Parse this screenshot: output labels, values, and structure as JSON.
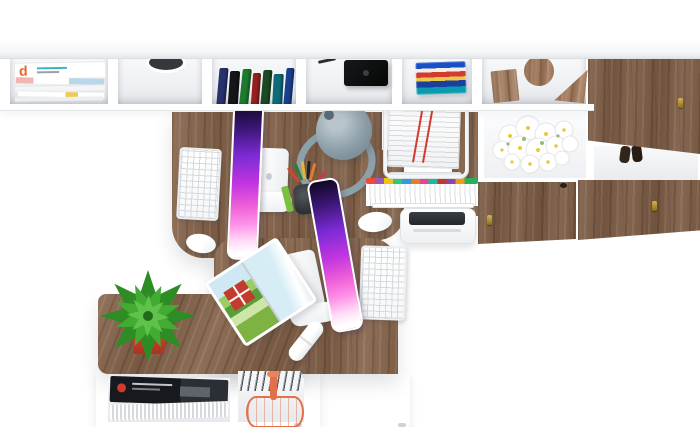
{
  "meta": {
    "title": "Top-down render of two-person home office furniture set",
    "view": "bird's-eye",
    "background_color": "#ffffff"
  },
  "palette": {
    "wood": "#85634a",
    "furniture_white": "#ffffff",
    "screen_purple": "#7c2bd6",
    "screen_pink": "#ff93e9",
    "lamp_gray": "#8c9ea8",
    "plant_green": "#43ab33",
    "pot_red": "#c7402c",
    "copper_basket": "#e0714a",
    "flower_white": "#ffffff",
    "flower_center_yellow": "#e8c83c",
    "speaker_black": "#0c0d0e"
  },
  "shelf": {
    "magazine_logo": "d",
    "book_spines": [
      "#28336e",
      "#14161a",
      "#1f7a2e",
      "#962020",
      "#1c4a23",
      "#0d6b7a",
      "#1b3f8f"
    ],
    "stacked_books": "linear-gradient(180deg,#1850c8 0 19%,#f5f0e6 19% 31%,#d23b2e 31% 47%,#ecc94b 47% 59%,#1a3f9e 59% 78%,#0a9bb0 78% 100%)",
    "contents": [
      "magazine stack",
      "cable grommet",
      "standing books",
      "black speaker box",
      "stacked blue books",
      "wooden bookends",
      "oak cabinet door"
    ]
  },
  "right_cabinet": {
    "contents": [
      "white daisy bouquet",
      "dark slippers",
      "oak doors with brass keyholes"
    ]
  },
  "workstations": {
    "desk_items": [
      "white monitor with purple screen",
      "white monitor with purple screen",
      "white keyboard",
      "white keyboard",
      "white mouse",
      "white mouse",
      "gray desk lamp",
      "pencil cup",
      "open travel magazine",
      "white stapler"
    ],
    "side_items": [
      "document trolley with papers",
      "hanging files with color tabs",
      "white printer"
    ]
  },
  "sideboard": {
    "contents": [
      "green succulent in red pot",
      "magazine pile",
      "standing files",
      "copper wire basket"
    ]
  },
  "pedestal": {
    "contents": [
      "white drawer unit"
    ]
  }
}
